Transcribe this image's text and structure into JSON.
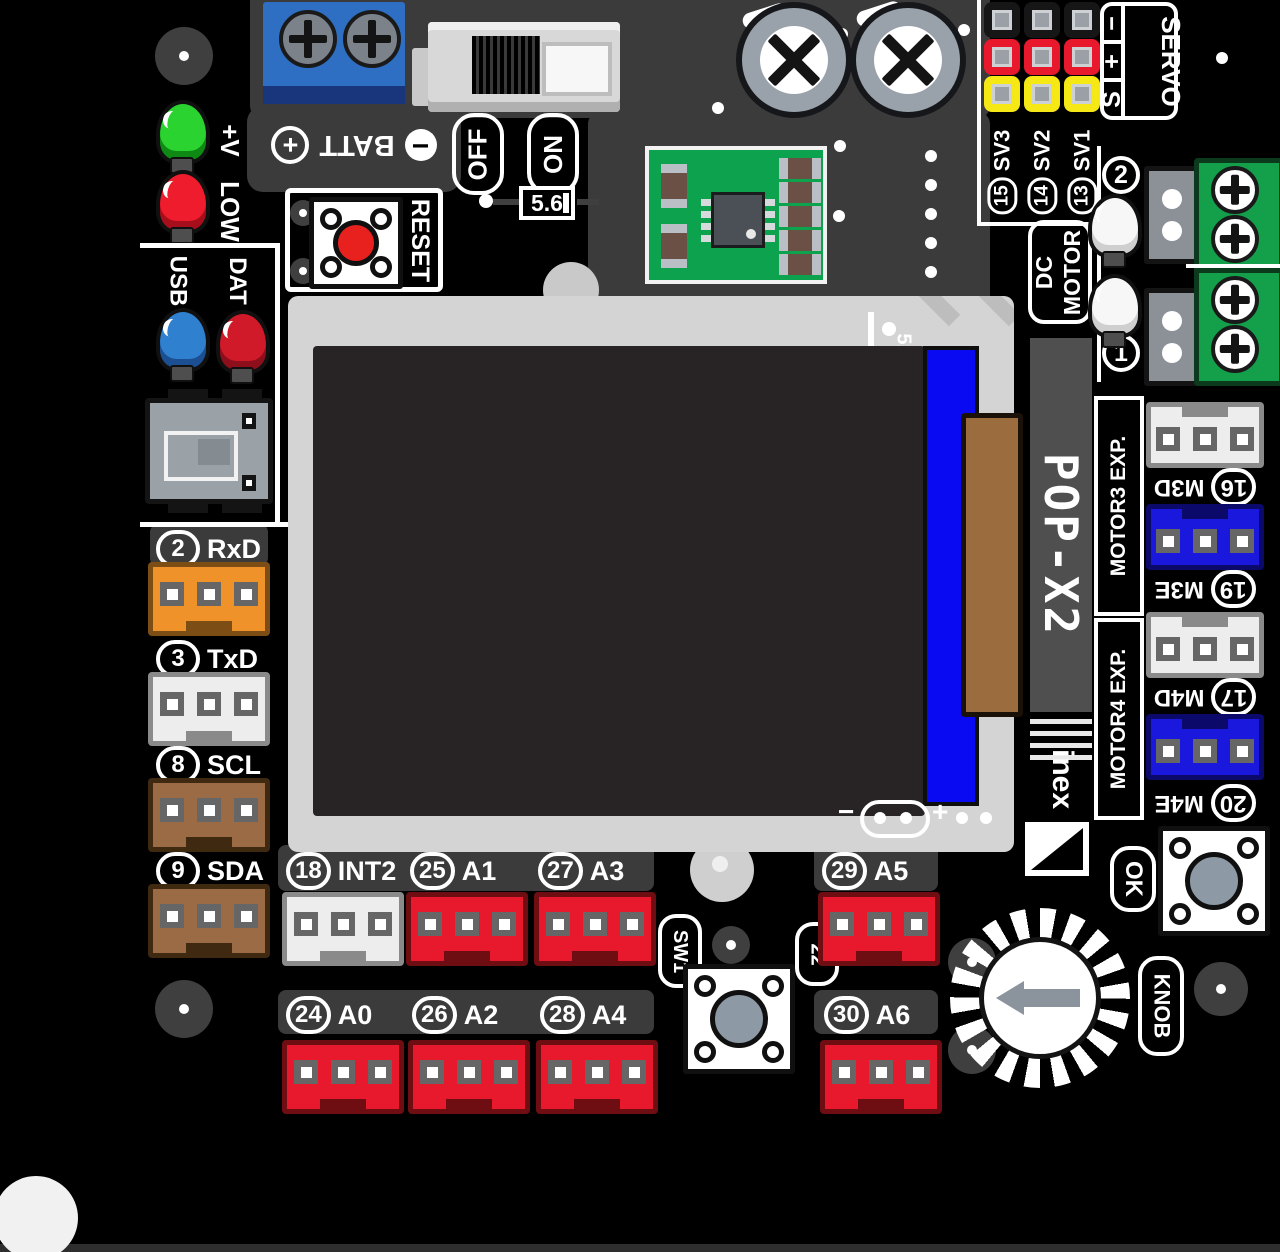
{
  "battery": {
    "minus": "−",
    "text": "BATT",
    "plus": "+"
  },
  "power_switch": {
    "off": "OFF",
    "on": "ON"
  },
  "component": {
    "value": "5.6"
  },
  "reset": {
    "label": "RESET"
  },
  "leds": {
    "vplus": "+V",
    "low": "LOW",
    "usb": "USB",
    "dat": "DAT"
  },
  "servo": {
    "title": "SERVO",
    "pin_minus": "−",
    "pin_plus": "+",
    "pin_signal": "S",
    "channels": [
      {
        "num": "15",
        "name": "SV3"
      },
      {
        "num": "14",
        "name": "SV2"
      },
      {
        "num": "13",
        "name": "SV1"
      }
    ]
  },
  "dc_motor": {
    "line1": "DC",
    "line2": "MOTOR",
    "ch_top": "2",
    "ch_bottom": "1"
  },
  "display": {
    "ref": "51",
    "pad_minus": "−",
    "pad_plus": "+"
  },
  "branding": {
    "model": "POP-X2",
    "logo": "inex"
  },
  "motor_exp": {
    "m3_title": "MOTOR3 EXP.",
    "m4_title": "MOTOR4 EXP.",
    "ports": [
      {
        "num": "16",
        "name": "M3D"
      },
      {
        "num": "19",
        "name": "M3E"
      },
      {
        "num": "17",
        "name": "M4D"
      },
      {
        "num": "20",
        "name": "M4E"
      }
    ]
  },
  "side_ports": [
    {
      "num": "2",
      "name": "RxD"
    },
    {
      "num": "3",
      "name": "TxD"
    },
    {
      "num": "8",
      "name": "SCL"
    },
    {
      "num": "9",
      "name": "SDA"
    }
  ],
  "bottom_ports": {
    "row1": [
      {
        "num": "18",
        "name": "INT2"
      },
      {
        "num": "25",
        "name": "A1"
      },
      {
        "num": "27",
        "name": "A3"
      },
      {
        "num": "29",
        "name": "A5"
      }
    ],
    "row2": [
      {
        "num": "24",
        "name": "A0"
      },
      {
        "num": "26",
        "name": "A2"
      },
      {
        "num": "28",
        "name": "A4"
      },
      {
        "num": "30",
        "name": "A6"
      }
    ]
  },
  "controls": {
    "sw1": "SW1",
    "hole": "22",
    "ok": "OK",
    "knob": "KNOB"
  },
  "colors": {
    "board_black": "#000000",
    "zone_gray": "#3b3b3b",
    "silk_white": "#ffffff",
    "signal_red": "#e8192c",
    "header_yellow": "#f5e815",
    "port_orange": "#f0922a",
    "port_brown": "#9a6b44",
    "port_blue": "#1a18dd",
    "terminal_green": "#14a04b",
    "terminal_blue": "#2e6fc4",
    "lcd_frame_gray": "#d4d4d4",
    "lcd_black": "#282425",
    "lcd_flex_blue": "#0a0af2",
    "lcd_connector_brown": "#9b6c3e",
    "module_green": "#0da24d"
  }
}
